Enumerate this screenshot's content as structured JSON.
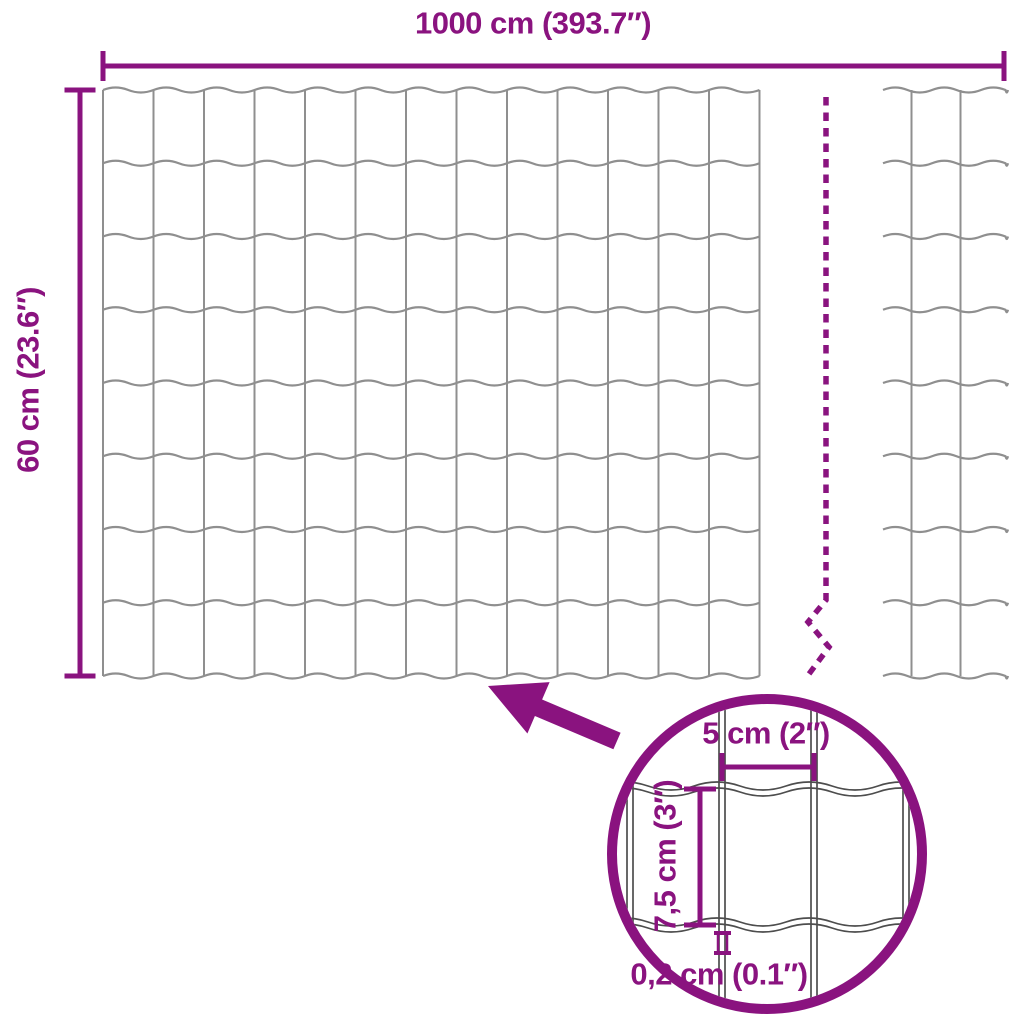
{
  "diagram": {
    "width_label": "1000 cm (393.7″)",
    "height_label": "60 cm (23.6″)",
    "detail": {
      "cell_width_label": "5 cm (2″)",
      "cell_height_label": "7,5 cm (3″)",
      "wire_thickness_label": "0,2 cm (0.1″)"
    }
  },
  "colors": {
    "accent": "#8A137F",
    "wire": "#8F8F8F",
    "detail_wire": "#4D4D4D",
    "background": "#FFFFFF"
  },
  "geometry": {
    "canvas": {
      "w": 1024,
      "h": 1024
    },
    "main_mesh": {
      "x0": 103,
      "y0": 90,
      "cols": 13,
      "rows": 8,
      "dx": 50.5,
      "dy": 73.25,
      "amp": 2.5
    },
    "side_mesh": {
      "x_start": 883,
      "x_end": 1008,
      "wire_xs": [
        911.5,
        960.5
      ],
      "y0": 90,
      "rows": 8,
      "dy": 73.25,
      "wl": 49,
      "amp": 2.5
    },
    "top_dim": {
      "x0": 103,
      "x1": 1004,
      "y": 66,
      "tick": 30,
      "stroke": 5
    },
    "left_dim": {
      "x": 80,
      "y0": 90,
      "y1": 676,
      "tick": 31,
      "stroke": 5
    },
    "break_line": {
      "pts": [
        [
          826,
          97
        ],
        [
          826,
          600
        ],
        [
          808,
          622
        ],
        [
          829,
          647
        ],
        [
          806,
          678
        ]
      ],
      "dash": "8.5 7",
      "stroke": 5.5
    },
    "circle": {
      "cx": 767,
      "cy": 854,
      "r": 155,
      "stroke": 10,
      "clip_r": 150
    },
    "detail": {
      "v_wires": [
        630,
        722,
        814,
        906
      ],
      "h_wires": [
        789,
        925
      ],
      "gap": 3,
      "wl": 92,
      "amp": 4,
      "x_span": [
        602,
        932
      ],
      "y_span": [
        695,
        1016
      ],
      "dim5": {
        "x0": 722,
        "x1": 814,
        "y": 767,
        "tick": 28,
        "stroke": 5
      },
      "dim75": {
        "x": 700,
        "y0": 789,
        "y1": 925,
        "tick": 32,
        "stroke": 5
      },
      "dim02": {
        "x0": 714,
        "x1": 731,
        "y0": 933,
        "y1": 953,
        "rail_xs": [
          718,
          727
        ]
      }
    },
    "arrow": [
      [
        488,
        686
      ],
      [
        549.6,
        682.1
      ],
      [
        542.1,
        699.5
      ],
      [
        620.6,
        732.7
      ],
      [
        613.4,
        749.3
      ],
      [
        534.9,
        716
      ],
      [
        527.4,
        733.5
      ]
    ],
    "labels": {
      "width": {
        "x": 533,
        "y": 23
      },
      "height": {
        "x": 28,
        "y": 380
      },
      "cell_width": {
        "x": 766,
        "y": 733
      },
      "cell_height": {
        "x": 665,
        "y": 856
      },
      "thickness": {
        "x": 719,
        "y": 974
      }
    }
  }
}
